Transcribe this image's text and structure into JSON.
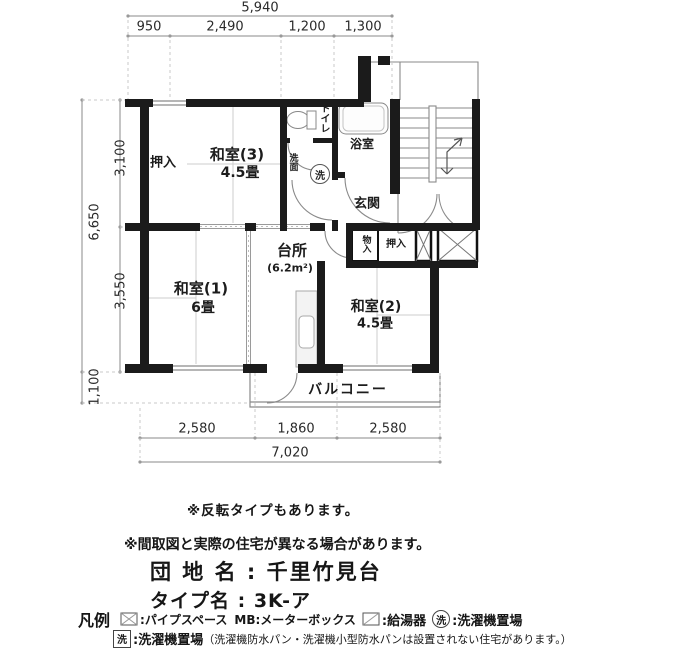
{
  "plan": {
    "dims_top": {
      "total": "5,940",
      "seg1": "950",
      "seg2": "2,490",
      "seg3": "1,200",
      "seg4": "1,300"
    },
    "dims_left": {
      "total": "6,650",
      "seg1": "3,100",
      "seg2": "3,550",
      "seg3": "1,100"
    },
    "dims_bottom": {
      "seg1": "2,580",
      "seg2": "1,860",
      "seg3": "2,580",
      "total": "7,020"
    },
    "rooms": {
      "oshiire_top": "押入",
      "washitsu3": "和室(3)",
      "washitsu3_size": "4.5畳",
      "toilet": "トイレ",
      "bath": "浴室",
      "senmen": "洗面",
      "washer_mark": "洗",
      "genkan": "玄関",
      "kitchen": "台所",
      "kitchen_size": "(6.2m²)",
      "washitsu1": "和室(1)",
      "washitsu1_size": "6畳",
      "washitsu2": "和室(2)",
      "washitsu2_size": "4.5畳",
      "monoire": "物入",
      "oshiire_bottom": "押入",
      "balcony": "バルコニー"
    }
  },
  "notes": {
    "reverse": "※反転タイプもあります。",
    "disclaimer": "※間取図と実際の住宅が異なる場合があります。",
    "estate_label": "団 地 名 : 千里竹見台",
    "type_label": "タイプ名 : 3K-ア"
  },
  "legend": {
    "title": "凡例",
    "pipe_space_label": ":パイプスペース",
    "meter_box_label": "MB:メーターボックス",
    "water_heater_label": ":給湯器",
    "washer_circle_mark": "洗",
    "washer_circle_label": ":洗濯機置場",
    "washer_box_mark": "洗",
    "washer_box_label": ":洗濯機置場",
    "washer_box_note": "（洗濯機防水パン・洗濯機小型防水パンは設置されない住宅があります。）"
  },
  "colors": {
    "wall": "#1b1b1b",
    "thin_line": "#8a8a8a",
    "text": "#1f1f1f"
  }
}
